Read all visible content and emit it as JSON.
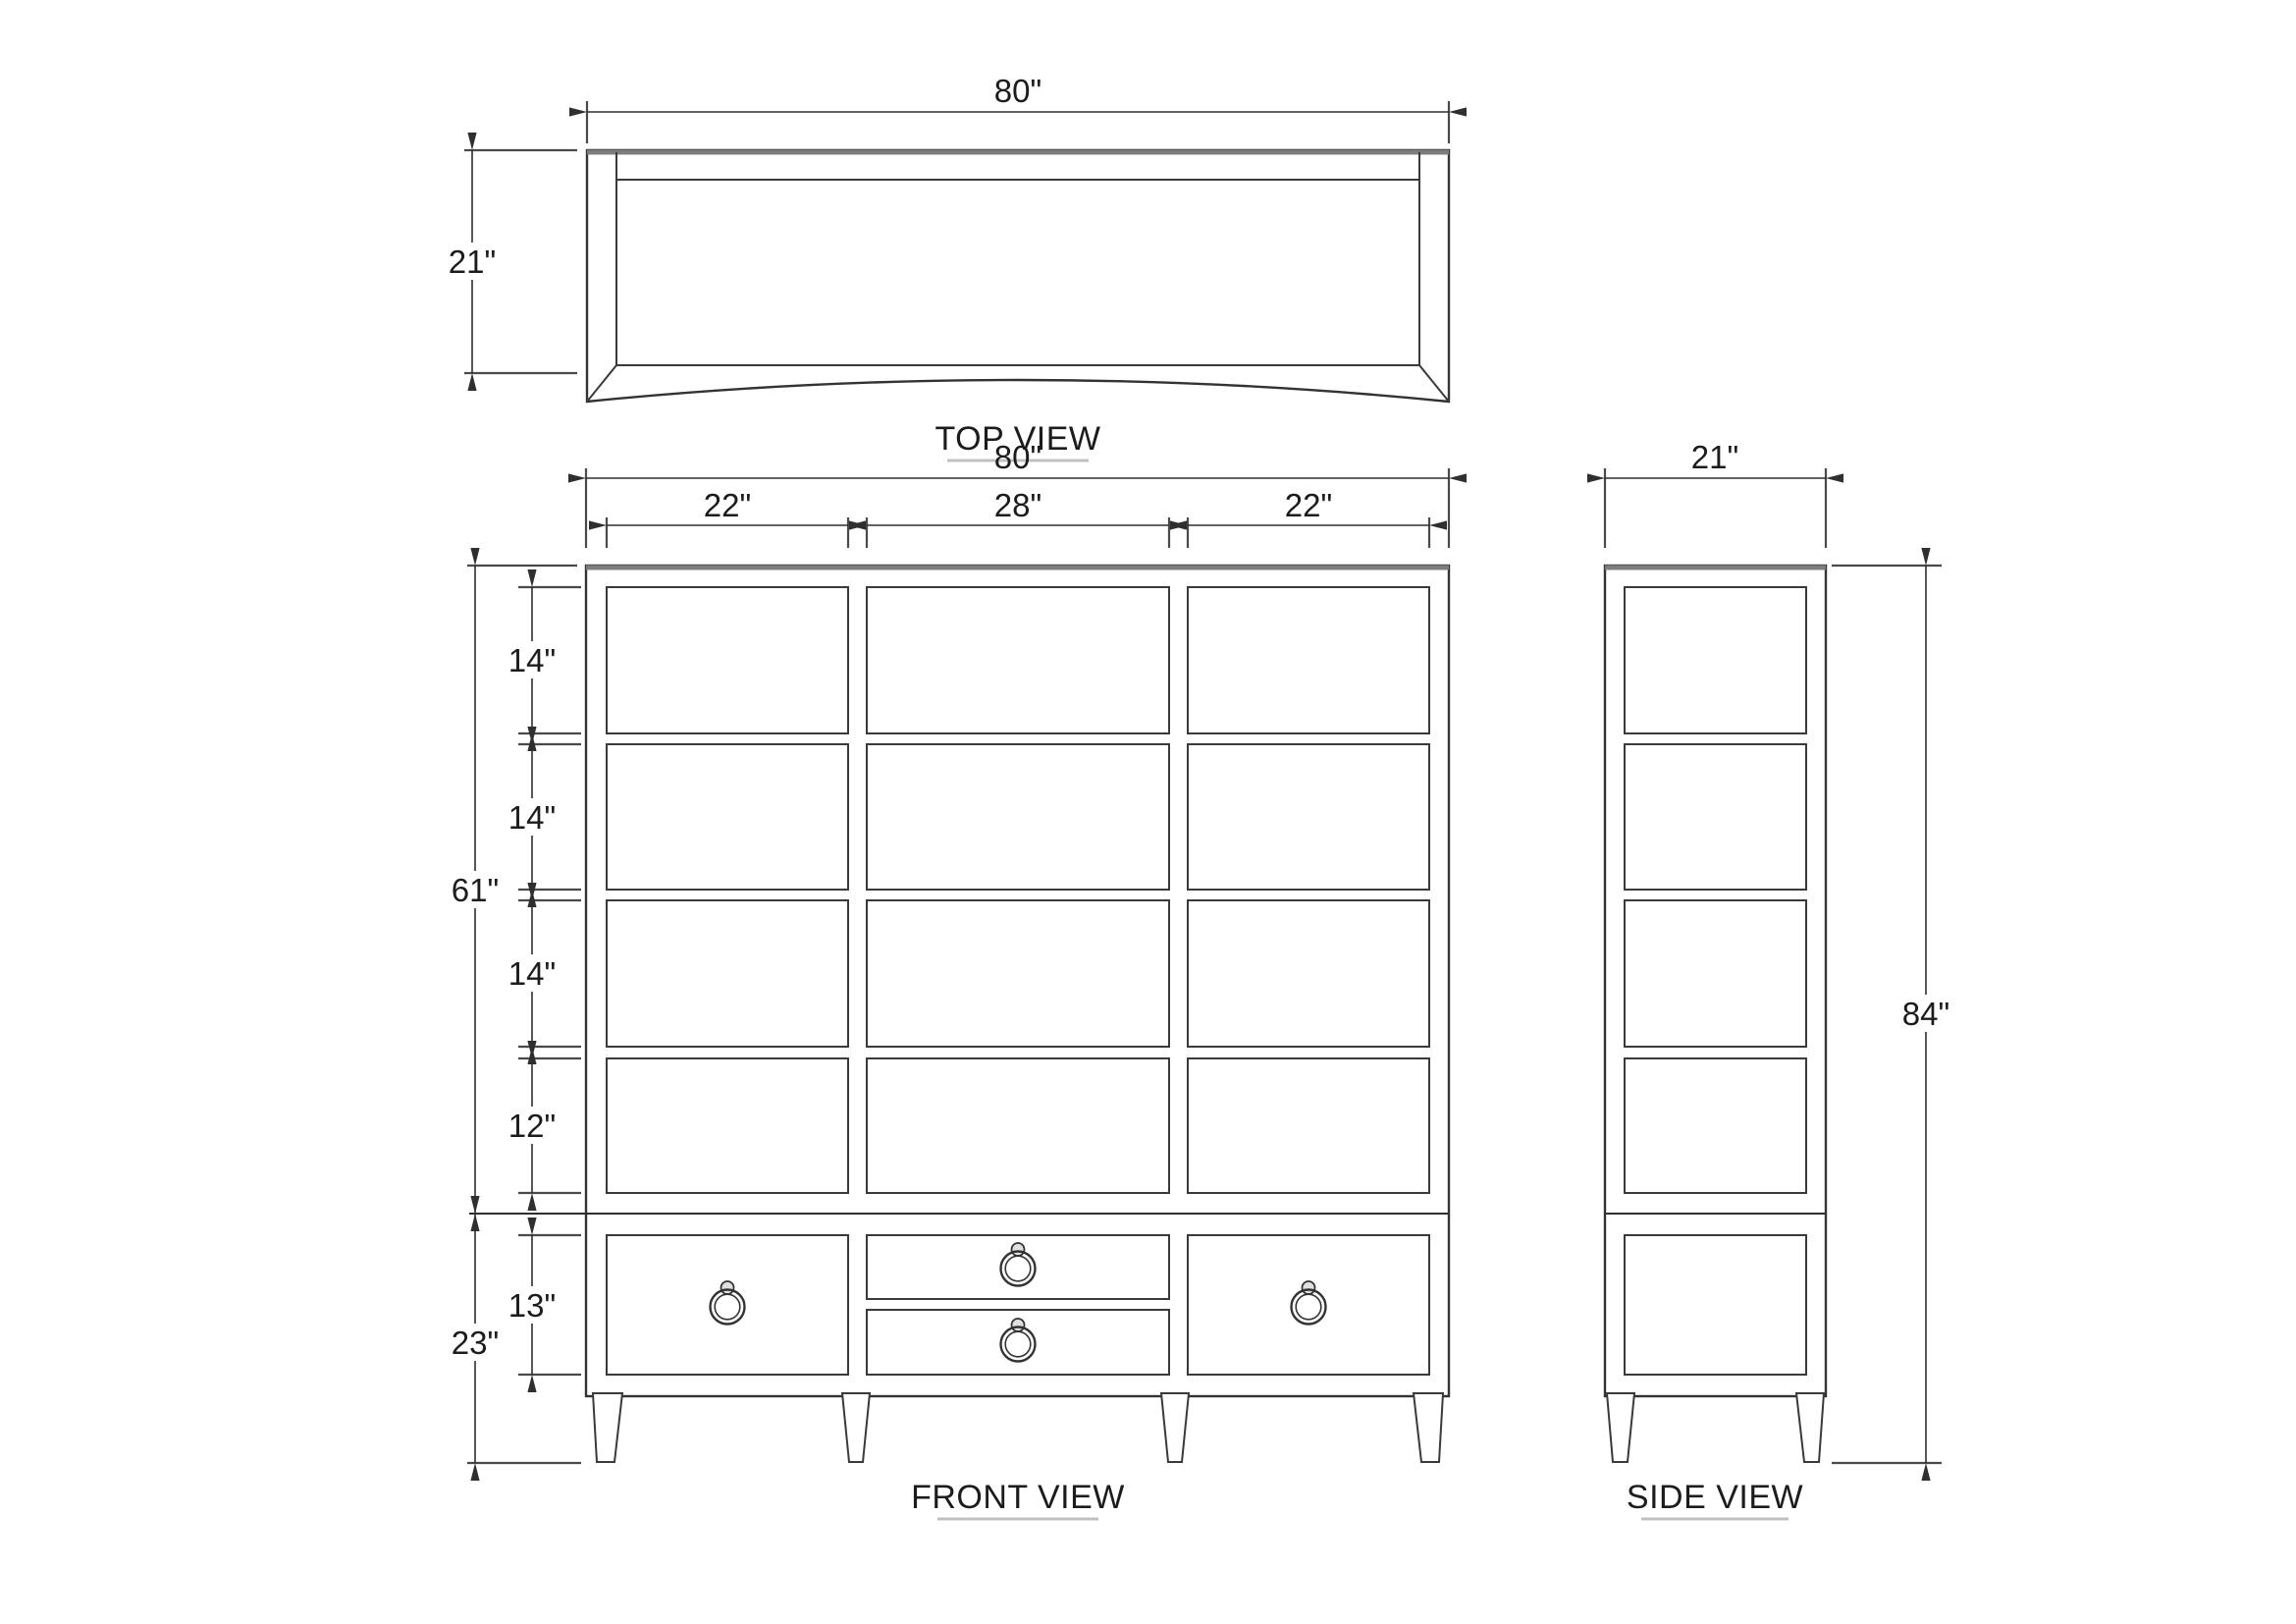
{
  "views": {
    "top": {
      "label": "TOP VIEW",
      "dims": {
        "width": "80\"",
        "depth": "21\""
      }
    },
    "front": {
      "label": "FRONT VIEW",
      "dims": {
        "width": "80\"",
        "opening_left": "22\"",
        "opening_center": "28\"",
        "opening_right": "22\"",
        "upper_section": "61\"",
        "shelf_row_1": "14\"",
        "shelf_row_2": "14\"",
        "shelf_row_3": "14\"",
        "shelf_row_4": "12\"",
        "lower_section": "23\"",
        "drawer": "13\""
      }
    },
    "side": {
      "label": "SIDE VIEW",
      "dims": {
        "depth": "21\"",
        "height": "84\""
      }
    }
  },
  "style": {
    "line_color": "#333333",
    "accent_line_color": "#7d7d7d",
    "underline_color": "#c0c0c0",
    "background": "#ffffff"
  }
}
